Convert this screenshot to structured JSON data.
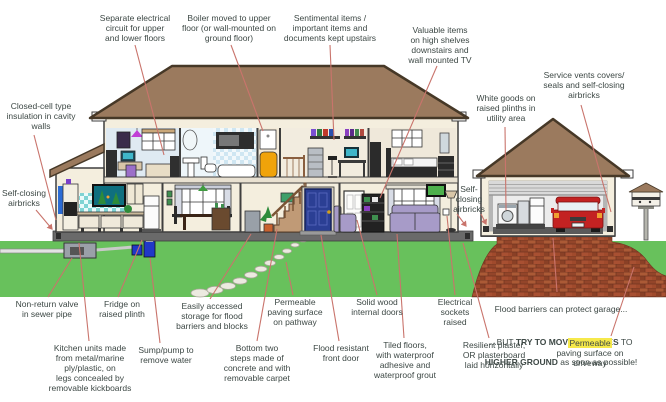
{
  "colors": {
    "text": "#3d4845",
    "leader": "#c9746c",
    "roof": "#9b7a5e",
    "roofline": "#463827",
    "wall": "#f4eede",
    "outline": "#3f3f3f",
    "grass": "#68c15c",
    "foundation": "#6a6a6a",
    "brick": "#a04a2c",
    "brickline": "#6f3320",
    "highlight": "#f6e94b",
    "doorblue": "#2b3f94",
    "tank": "#f0a30a",
    "teal": "#7fd3d3",
    "purple": "#a79bc8",
    "carred": "#c32222",
    "stairs": "#c09a76"
  },
  "labels": {
    "separate_circuit": {
      "text": "Separate electrical\ncircuit for upper\nand lower floors"
    },
    "boiler": {
      "text": "Boiler moved to upper\nfloor (or wall-mounted on\nground floor)"
    },
    "sentimental": {
      "text": "Sentimental items /\nimportant items and\ndocuments kept upstairs"
    },
    "valuable": {
      "text": "Valuable items\non high shelves\ndownstairs and\nwall mounted TV"
    },
    "service_vents": {
      "text": "Service vents covers/\nseals and self-closing\nairbricks"
    },
    "white_goods": {
      "text": "White goods on\nraised plinths in\nutility area"
    },
    "insulation": {
      "text": "Closed-cell type\ninsulation in cavity\nwalls"
    },
    "airbricks_left": {
      "text": "Self-closing\nairbricks"
    },
    "airbricks_mid": {
      "text": "Self-\nclosing\nairbricks"
    },
    "nonreturn": {
      "text": "Non-return valve\nin sewer pipe"
    },
    "fridge": {
      "text": "Fridge on\nraised plinth"
    },
    "kitchen_units": {
      "text": "Kitchen units made\nfrom metal/marine\nply/plastic, on\nlegs concealed by\nremovable kickboards"
    },
    "sump": {
      "text": "Sump/pump to\nremove water"
    },
    "storage": {
      "text": "Easily accessed\nstorage for flood\nbarriers and blocks"
    },
    "steps": {
      "text": "Bottom two\nsteps made of\nconcrete and with\nremovable carpet"
    },
    "paving_path": {
      "text": "Permeable\npaving surface\non pathway"
    },
    "front_door": {
      "text": "Flood resistant\nfront door"
    },
    "internal_doors": {
      "text": "Solid wood\ninternal doors"
    },
    "tiled_floors": {
      "text": "Tiled floors,\nwith waterproof\nadhesive and\nwaterproof grout"
    },
    "sockets": {
      "text": "Electrical\nsockets\nraised"
    },
    "plaster": {
      "text": "Resilient plaster,\nOR plasterboard\nlaid horizontally"
    },
    "flood_barriers": {
      "line1": "Flood barriers can protect garage...",
      "line2_pre": "...BUT ",
      "line2_bold": "TRY TO MOVE VEHICLES",
      "line2_post": " TO",
      "line3_bold": "HIGHER GROUND",
      "line3_rest": " as soon as possible!"
    },
    "paving_drive": {
      "highlight": "Permeable",
      "rest": "\npaving surface on\ndriveway"
    }
  }
}
